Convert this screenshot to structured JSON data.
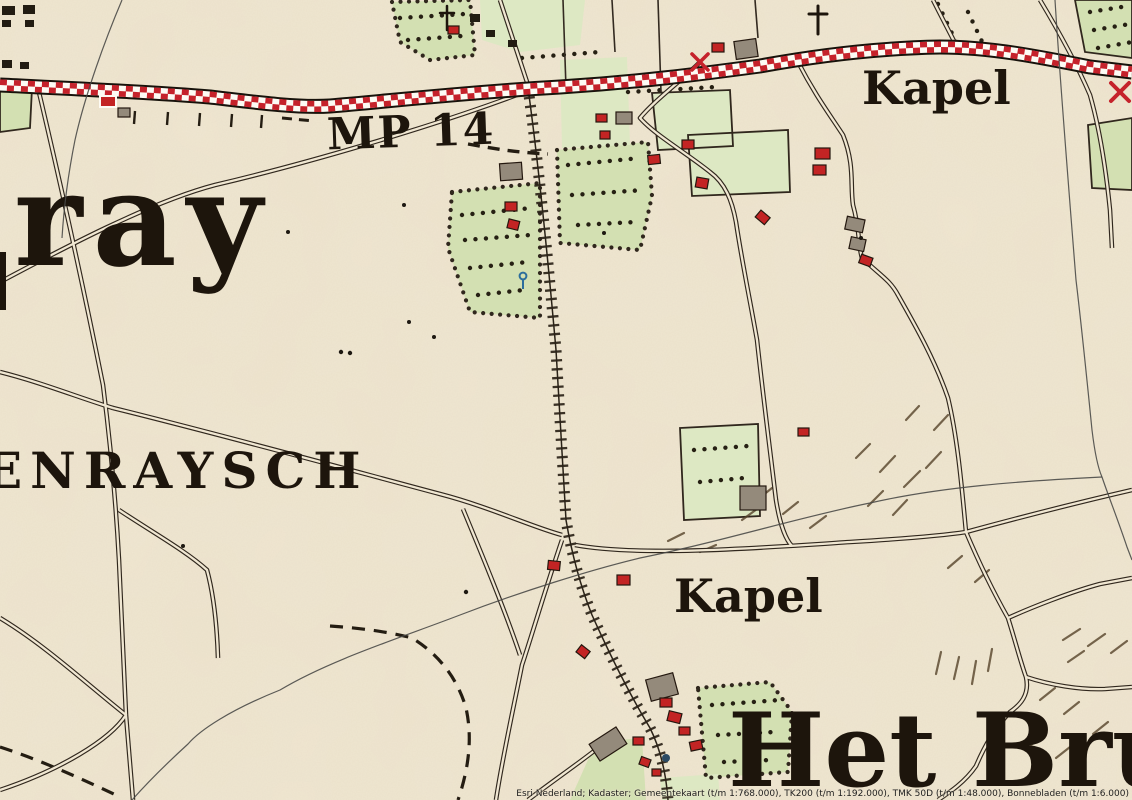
{
  "map": {
    "labels": {
      "place_name_partial": "ray",
      "heath_name_partial": "ENRAYSCH",
      "milepost": "MP 14",
      "chapel_north": "Kapel",
      "chapel_south": "Kapel",
      "hamlet_partial": "Het Brux"
    },
    "attribution": "Esri Nederland; Kadaster; Gemeentekaart (t/m 1:768.000), TK200 (t/m 1:192.000), TMK 50D (t/m 1:48.000), Bonnebladen (t/m 1:6.000)"
  },
  "colors": {
    "paper": "#f0e7d2",
    "ink": "#30271d",
    "label_ink": "#1d150c",
    "railway_red": "#c5222b",
    "field_green": "#d3e0b2",
    "field_green_light": "#dde8c3",
    "building_red": "#c32424",
    "building_grey": "#948a7b",
    "boundary_grey": "#4a4a48",
    "hachure_brown": "#55432a",
    "water_blue": "#2b6e9c"
  }
}
